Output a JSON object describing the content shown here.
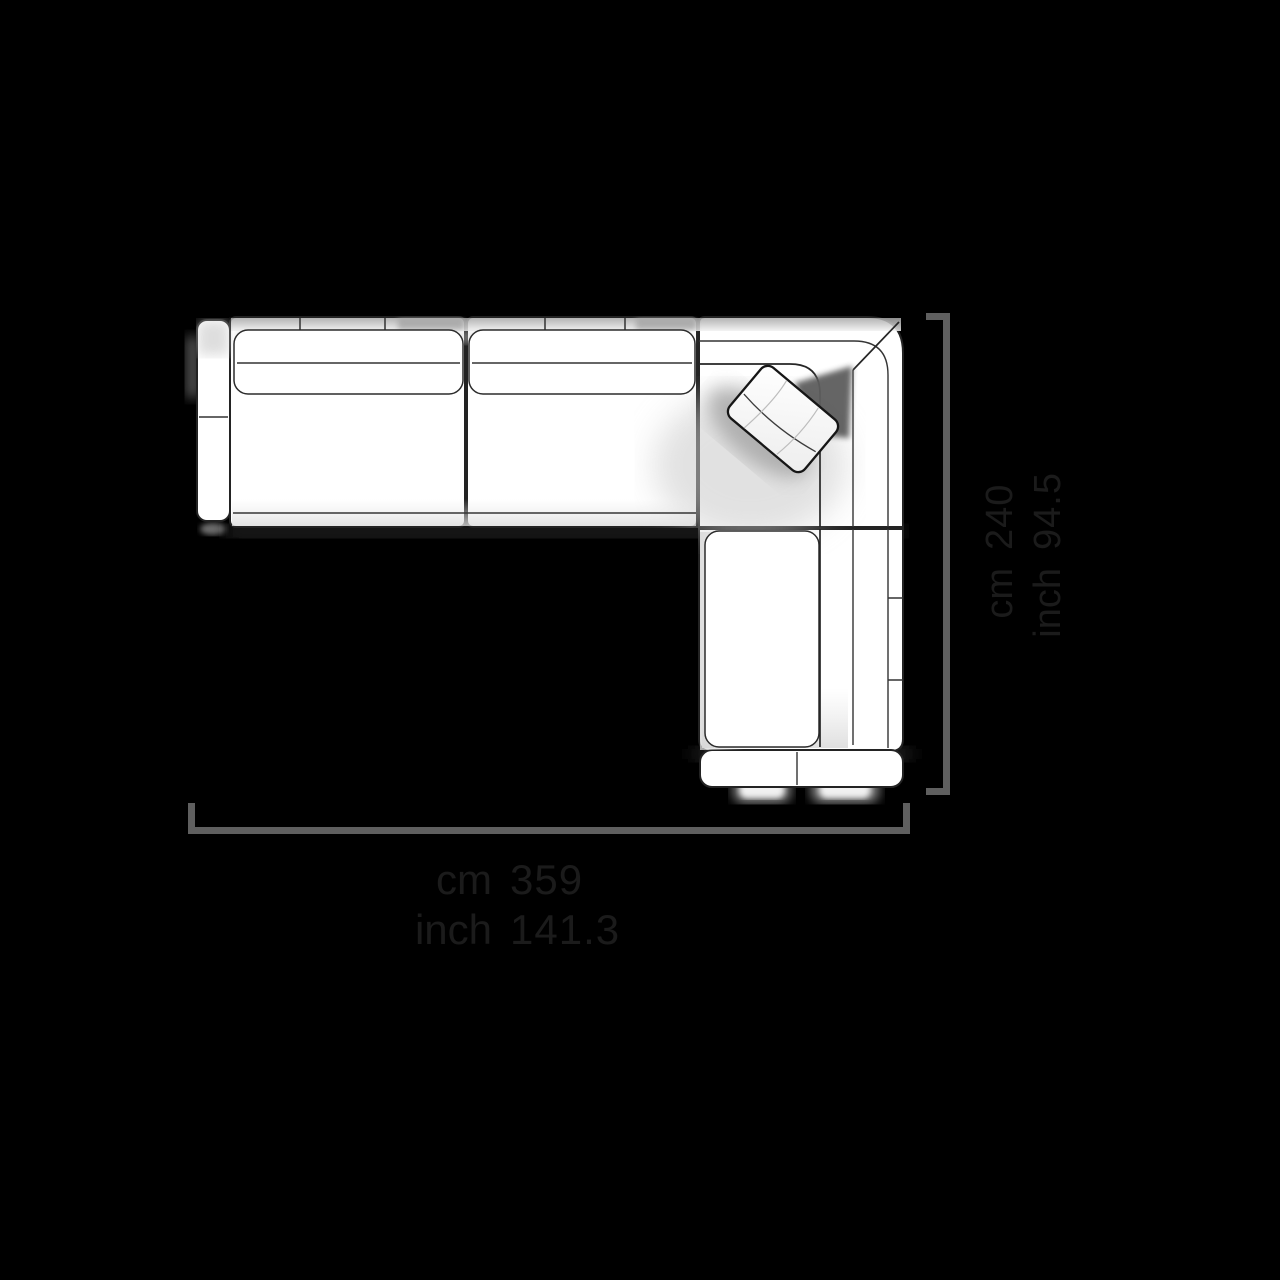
{
  "diagram": {
    "type": "sofa-top-view-dimension-diagram",
    "units": [
      "cm",
      "inch"
    ]
  },
  "dimensions": {
    "width": {
      "cm_label": "cm",
      "cm_value": "359",
      "inch_label": "inch",
      "inch_value": "141.3"
    },
    "depth": {
      "cm_label": "cm",
      "cm_value": "240",
      "inch_label": "inch",
      "inch_value": "94.5"
    }
  },
  "colors": {
    "bg": "#000000",
    "dimension_line": "#5f5f5f",
    "dimension_text": "#1b1b1b",
    "sofa_outline": "#232323",
    "sofa_fill": "#ffffff"
  }
}
